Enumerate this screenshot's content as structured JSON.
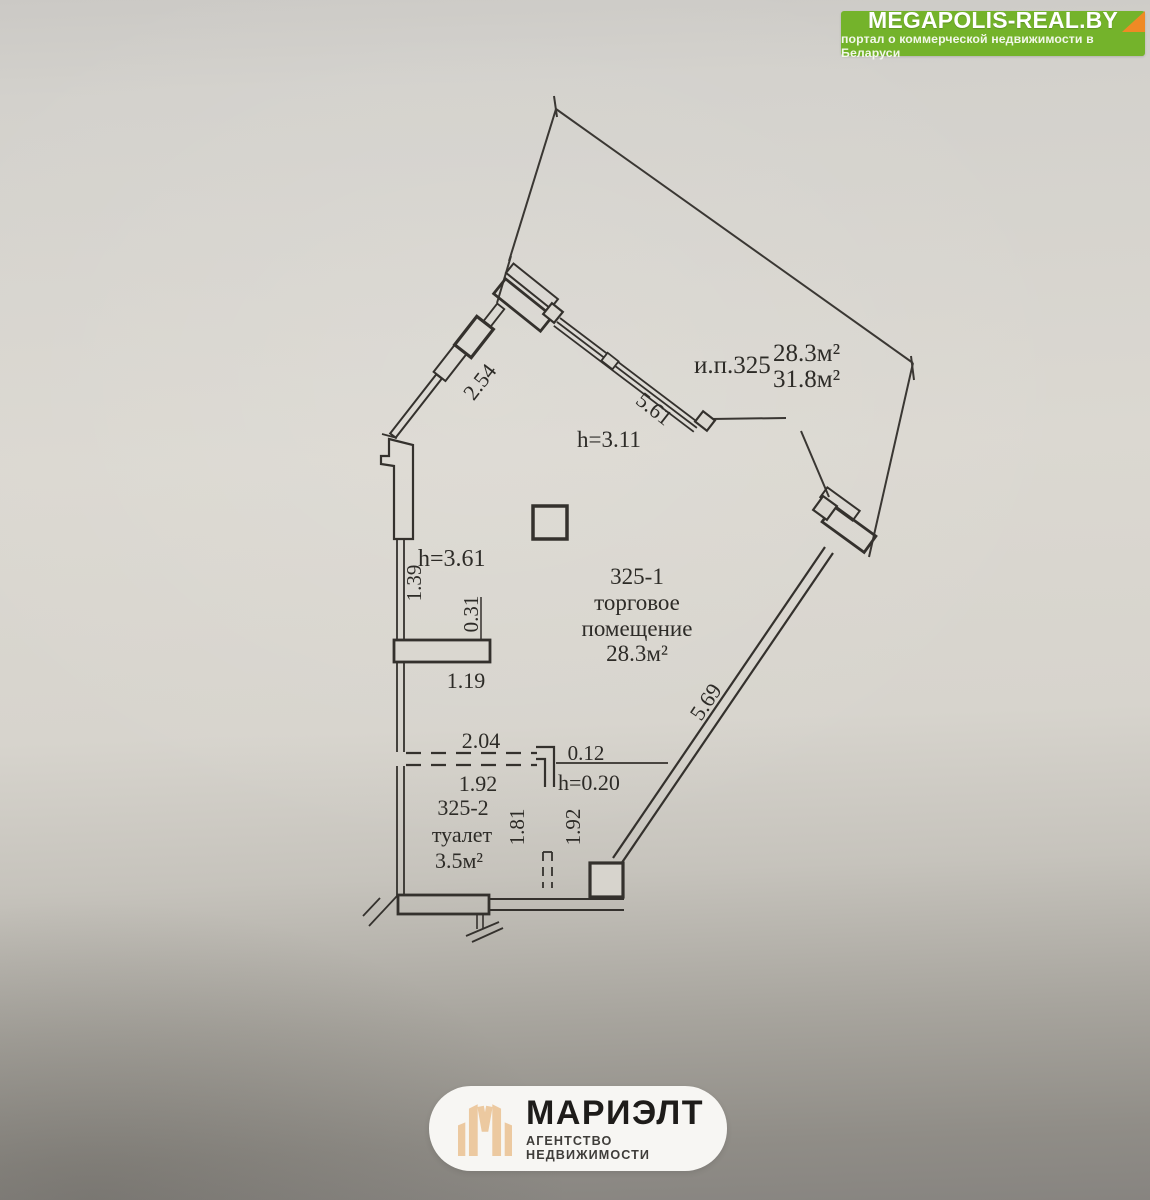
{
  "watermark": {
    "title": "MEGAPOLIS-REAL.BY",
    "subtitle": "портал о коммерческой недвижимости в Беларуси",
    "bg_color": "#74b32b",
    "fold_color": "#ef8a25"
  },
  "agency": {
    "name": "МАРИЭЛТ",
    "tagline": "АГЕНТСТВО НЕДВИЖИМОСТИ",
    "logo_color": "#ecc9a0"
  },
  "plan": {
    "unit_label": "и.п.325",
    "unit_area": "28.3м²",
    "unit_area_alt": "31.8м²",
    "height_main": "h=3.11",
    "height_left": "h=3.61",
    "room_main": {
      "number": "325-1",
      "name_line1": "торговое",
      "name_line2": "помещение",
      "area": "28.3м²"
    },
    "room_wc": {
      "number": "325-2",
      "name": "туалет",
      "area": "3.5м²"
    },
    "dims": {
      "wall_top_left": "2.54",
      "window": "5.61",
      "left_upper": "1.39",
      "stub_thickness": "0.31",
      "stub_length": "1.19",
      "partition_top": "2.04",
      "partition_bottom": "1.92",
      "opening": "0.12",
      "sill_height": "h=0.20",
      "wc_depth": "1.81",
      "wc_width": "1.92",
      "wall_right": "5.69"
    }
  }
}
